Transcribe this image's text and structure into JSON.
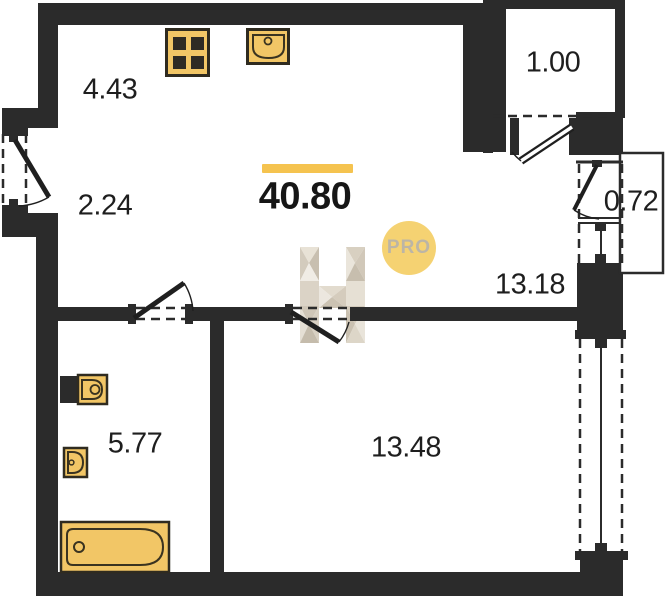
{
  "plan": {
    "title": "apartment-floor-plan",
    "total_area_label": "40.80",
    "areas": {
      "kitchen_zone": "4.43",
      "hallway_zone": "2.24",
      "balcony": "1.00",
      "wardrobe": "0.72",
      "kitchen_living": "13.18",
      "bathroom": "5.77",
      "bedroom": "13.48"
    },
    "badge": {
      "label": "PRO"
    },
    "watermark": {
      "letter": "H"
    },
    "icons": [
      "stove-icon",
      "kitchen-sink-icon",
      "toilet-icon",
      "bath-sink-icon",
      "bathtub-icon",
      "door-swing-icon",
      "window-icon"
    ],
    "colors": {
      "wall": "#2b2b2b",
      "fixture_fill": "#f2c666",
      "fixture_stroke": "#3a3320",
      "accent_bar": "#f5c34f",
      "badge_bg": "#f5d272",
      "badge_text": "#bcb5a6"
    }
  }
}
